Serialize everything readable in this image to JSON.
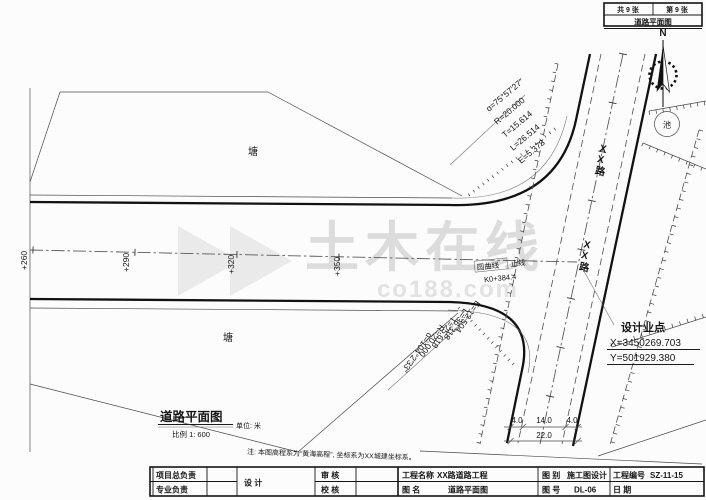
{
  "colors": {
    "line": "#121212",
    "watermark": "#dcdcdc",
    "paper": "#fcfcfc"
  },
  "sheet_header": {
    "volume": "共 9 张",
    "number": "第 9 张",
    "title": "道路平面图"
  },
  "north_label": "N",
  "watermark": {
    "text": "土木在线",
    "domain": "co188.com"
  },
  "curve_top": {
    "l1": "ɑ=75°57′27″",
    "l2": "R=20.000",
    "l3": "T=15.614",
    "l4": "L=26.514",
    "l5": "E=5.373"
  },
  "curve_bottom": {
    "l1": "ɑ=104°2′33″",
    "l2": "R=20.000",
    "l3": "T=25.618",
    "l4": "L=36.318",
    "l5": "E=12.504"
  },
  "roads": {
    "cross_road_name": "XX路",
    "cross_road_name_2": "XX路"
  },
  "ponds": {
    "upper": "塘",
    "lower": "塘"
  },
  "pool_label": "池",
  "chainage": {
    "c1": "+260",
    "c2": "+290",
    "c3": "+320",
    "c4": "+350"
  },
  "centerline_note": {
    "boxed": "圆曲线",
    "suffix": "止线",
    "station": "K0+384.4"
  },
  "design_point": {
    "title": "设计业点",
    "x": "X=3450269.703",
    "y": "Y=501929.380"
  },
  "dimensions": {
    "left": "4.0",
    "middle": "14.0",
    "right": "4.0",
    "total": "22.0"
  },
  "plan_title": {
    "name": "道路平面图",
    "unit": "单位: 米",
    "scale": "比例 1: 600"
  },
  "note": "注: 本图高程系为“黄海高程”, 坐标系为XX城建坐标系。",
  "title_block": {
    "project_lead": "项目总负责",
    "discipline_lead": "专业负责",
    "design": "设  计",
    "review": "审  核",
    "check": "校  核",
    "project_name_label": "工程名称",
    "project_name": "XX路道路工程",
    "drawing_name_label": "图  名",
    "drawing_name": "道路平面图",
    "category_label": "图  别",
    "category": "施工图设计",
    "number_label": "图  号",
    "number": "DL-06",
    "project_no_label": "工程编号",
    "project_no": "SZ-11-15",
    "date_label": "日  期"
  }
}
